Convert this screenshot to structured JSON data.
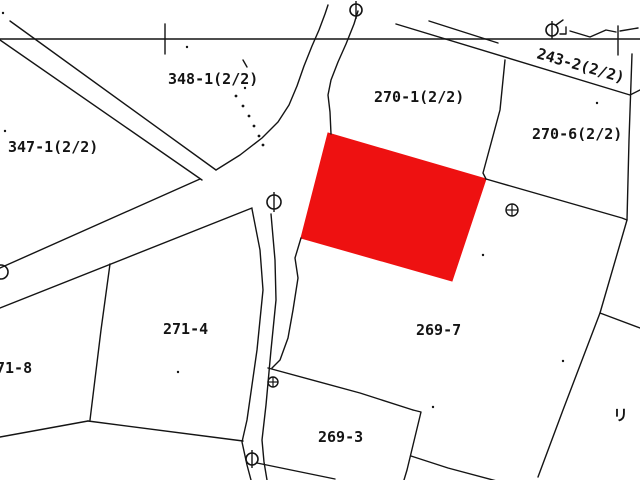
{
  "map": {
    "width": 640,
    "height": 480,
    "colors": {
      "background": "#ffffff",
      "line": "#141414",
      "highlight": "#ee1111"
    },
    "labels": [
      {
        "name": "parcel-label-348-1",
        "label": "348-1(2/2)",
        "x": 168,
        "y": 84
      },
      {
        "name": "parcel-label-347-1",
        "label": "347-1(2/2)",
        "x": 8,
        "y": 152
      },
      {
        "name": "parcel-label-270-1",
        "label": "270-1(2/2)",
        "x": 374,
        "y": 102
      },
      {
        "name": "parcel-label-243-2",
        "label": "243-2(2/2)",
        "x": 536,
        "y": 58,
        "transform": "rotate(16 536 58)"
      },
      {
        "name": "parcel-label-270-6",
        "label": "270-6(2/2)",
        "x": 532,
        "y": 139
      },
      {
        "name": "parcel-label-271-4",
        "label": "271-4",
        "x": 163,
        "y": 334
      },
      {
        "name": "parcel-label-71-8",
        "label": "71-8",
        "x": -4,
        "y": 373
      },
      {
        "name": "parcel-label-269-7",
        "label": "269-7",
        "x": 416,
        "y": 335
      },
      {
        "name": "parcel-label-269-3",
        "label": "269-3",
        "x": 318,
        "y": 442
      }
    ],
    "partial_glyph": {
      "name": "edge-partial-glyph",
      "label": "リ",
      "x": 613,
      "y": 420
    },
    "highlight_parcel": {
      "name": "highlighted-parcel",
      "points": [
        [
          328,
          133
        ],
        [
          486,
          179
        ],
        [
          452,
          281
        ],
        [
          301,
          238
        ]
      ]
    },
    "lines": [
      {
        "name": "survey-baseline",
        "pts": [
          [
            0,
            39
          ],
          [
            640,
            39
          ]
        ]
      },
      {
        "name": "survey-tick-left",
        "pts": [
          [
            165,
            24
          ],
          [
            165,
            54
          ]
        ]
      },
      {
        "name": "survey-tick-right",
        "pts": [
          [
            618,
            26
          ],
          [
            618,
            55
          ]
        ]
      },
      {
        "name": "road-nw-north-edge",
        "pts": [
          [
            10,
            21
          ],
          [
            216,
            170
          ]
        ]
      },
      {
        "name": "road-nw-south-edge",
        "pts": [
          [
            0,
            40
          ],
          [
            202,
            180
          ]
        ]
      },
      {
        "name": "road-west-north-edge",
        "pts": [
          [
            0,
            268
          ],
          [
            200,
            179
          ]
        ]
      },
      {
        "name": "road-west-south-edge",
        "pts": [
          [
            0,
            308
          ],
          [
            252,
            208
          ]
        ]
      },
      {
        "name": "road-north-left-edge",
        "pts": [
          [
            216,
            170
          ],
          [
            240,
            155
          ],
          [
            262,
            138
          ],
          [
            278,
            122
          ],
          [
            289,
            105
          ],
          [
            297,
            86
          ],
          [
            304,
            66
          ],
          [
            312,
            46
          ],
          [
            319,
            30
          ],
          [
            325,
            14
          ],
          [
            328,
            5
          ]
        ]
      },
      {
        "name": "road-north-right-edge",
        "pts": [
          [
            358,
            11
          ],
          [
            354,
            24
          ],
          [
            346,
            44
          ],
          [
            338,
            62
          ],
          [
            331,
            80
          ],
          [
            328,
            95
          ],
          [
            330,
            112
          ],
          [
            331,
            134
          ]
        ]
      },
      {
        "name": "road-south-left-edge",
        "pts": [
          [
            252,
            209
          ],
          [
            260,
            250
          ],
          [
            263,
            290
          ],
          [
            257,
            350
          ],
          [
            247,
            420
          ],
          [
            242,
            442
          ],
          [
            247,
            465
          ],
          [
            251,
            480
          ]
        ]
      },
      {
        "name": "road-south-right-edge",
        "pts": [
          [
            271,
            214
          ],
          [
            275,
            260
          ],
          [
            276,
            300
          ],
          [
            271,
            350
          ],
          [
            266,
            405
          ],
          [
            262,
            440
          ],
          [
            264,
            462
          ],
          [
            267,
            480
          ]
        ]
      },
      {
        "name": "boundary-269-7-west",
        "pts": [
          [
            301,
            238
          ],
          [
            295,
            258
          ],
          [
            298,
            278
          ],
          [
            293,
            310
          ],
          [
            288,
            338
          ],
          [
            280,
            360
          ],
          [
            272,
            368
          ]
        ]
      },
      {
        "name": "boundary-243-2-lower",
        "pts": [
          [
            396,
            24
          ],
          [
            630,
            95
          ],
          [
            640,
            90
          ]
        ]
      },
      {
        "name": "boundary-243-2-upper",
        "pts": [
          [
            429,
            21
          ],
          [
            498,
            43
          ]
        ]
      },
      {
        "name": "boundary-270-1-east",
        "pts": [
          [
            505,
            60
          ],
          [
            500,
            110
          ],
          [
            483,
            173
          ],
          [
            486,
            179
          ]
        ]
      },
      {
        "name": "boundary-269-7-north",
        "pts": [
          [
            486,
            179
          ],
          [
            622,
            218
          ],
          [
            627,
            220
          ]
        ]
      },
      {
        "name": "boundary-east-long",
        "pts": [
          [
            632,
            54
          ],
          [
            629,
            140
          ],
          [
            627,
            220
          ],
          [
            600,
            313
          ],
          [
            563,
            410
          ],
          [
            538,
            477
          ]
        ]
      },
      {
        "name": "boundary-east-branch",
        "pts": [
          [
            600,
            313
          ],
          [
            640,
            328
          ]
        ]
      },
      {
        "name": "boundary-269-7-south",
        "pts": [
          [
            268,
            368
          ],
          [
            360,
            393
          ],
          [
            413,
            410
          ]
        ]
      },
      {
        "name": "boundary-269-3-east",
        "pts": [
          [
            413,
            410
          ],
          [
            421,
            412
          ],
          [
            407,
            470
          ],
          [
            404,
            480
          ]
        ]
      },
      {
        "name": "boundary-269-3-southeast",
        "pts": [
          [
            411,
            456
          ],
          [
            448,
            468
          ],
          [
            508,
            484
          ]
        ]
      },
      {
        "name": "boundary-bottom-diagonal",
        "pts": [
          [
            257,
            463
          ],
          [
            335,
            479
          ]
        ]
      },
      {
        "name": "boundary-271-4-west",
        "pts": [
          [
            110,
            264
          ],
          [
            101,
            330
          ],
          [
            90,
            420
          ]
        ]
      },
      {
        "name": "boundary-271-4-south",
        "pts": [
          [
            88,
            421
          ],
          [
            243,
            441
          ]
        ]
      },
      {
        "name": "boundary-71-8-south",
        "pts": [
          [
            0,
            437
          ],
          [
            88,
            421
          ]
        ]
      },
      {
        "name": "marker-bracket",
        "pts": [
          [
            560,
            34
          ],
          [
            566,
            34
          ],
          [
            566,
            27
          ]
        ]
      },
      {
        "name": "marker-flag",
        "pts": [
          [
            556,
            25
          ],
          [
            563,
            20
          ]
        ]
      },
      {
        "name": "zigzag-left",
        "pts": [
          [
            570,
            31
          ],
          [
            590,
            37
          ],
          [
            606,
            30
          ],
          [
            616,
            32
          ]
        ]
      },
      {
        "name": "zigzag-right",
        "pts": [
          [
            620,
            31
          ],
          [
            638,
            28
          ]
        ]
      },
      {
        "name": "tick-above-348",
        "pts": [
          [
            243,
            60
          ],
          [
            247,
            67
          ]
        ]
      }
    ],
    "pole_symbols": [
      {
        "name": "pole-symbol-top",
        "x": 356,
        "y": 10,
        "r": 6
      },
      {
        "name": "pole-symbol-topright",
        "x": 552,
        "y": 30,
        "r": 6
      },
      {
        "name": "pole-symbol-junction",
        "x": 274,
        "y": 202,
        "r": 7
      },
      {
        "name": "pole-symbol-bottom",
        "x": 252,
        "y": 459,
        "r": 6
      }
    ],
    "edge_circle": {
      "name": "pole-symbol-left-edge",
      "x": 1,
      "y": 272,
      "r": 7
    },
    "benchmark_symbols": [
      {
        "name": "benchmark-symbol-east",
        "x": 512,
        "y": 210,
        "r": 6
      },
      {
        "name": "benchmark-symbol-center",
        "x": 273,
        "y": 382,
        "r": 5
      }
    ],
    "dotted_line": [
      [
        236,
        96
      ],
      [
        243,
        106
      ],
      [
        249,
        116
      ],
      [
        254,
        126
      ],
      [
        259,
        136
      ],
      [
        263,
        145
      ]
    ],
    "specks": [
      [
        3,
        13
      ],
      [
        245,
        88
      ],
      [
        178,
        372
      ],
      [
        563,
        361
      ],
      [
        433,
        407
      ],
      [
        483,
        255
      ],
      [
        597,
        103
      ],
      [
        5,
        131
      ],
      [
        187,
        47
      ]
    ]
  }
}
